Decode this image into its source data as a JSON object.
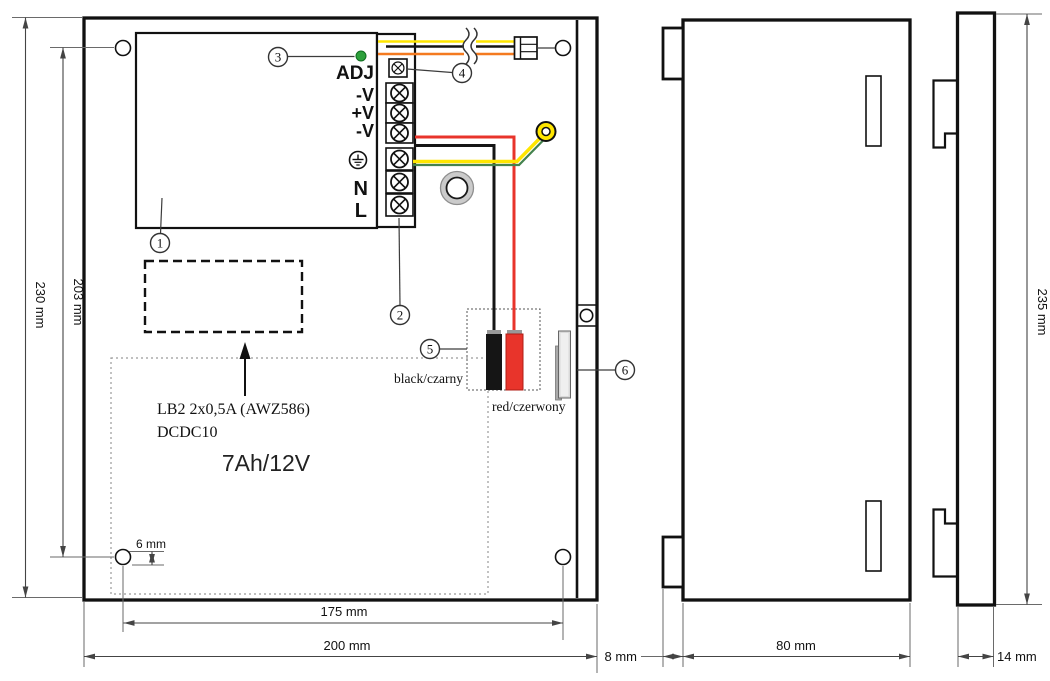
{
  "terminal": {
    "adj": "ADJ",
    "out1": "-V",
    "out2": "+V",
    "out3": "-V",
    "n": "N",
    "l": "L"
  },
  "callouts": [
    "1",
    "2",
    "3",
    "4",
    "5",
    "6"
  ],
  "module": {
    "line1": "LB2 2x0,5A (AWZ586)",
    "line2": "DCDC10"
  },
  "battery_label": "7Ah/12V",
  "wires": {
    "black": "black/czarny",
    "red": "red/czerwony"
  },
  "dims": {
    "front_height": "230 mm",
    "holes_height": "203 mm",
    "hole_diameter": "6 mm",
    "holes_width": "175 mm",
    "front_width": "200 mm",
    "side_height": "235 mm",
    "tab_depth": "8 mm",
    "body_depth": "80 mm",
    "door_depth": "14 mm"
  },
  "colors": {
    "wire_yellow": "#ffe600",
    "wire_orange": "#f47a20",
    "wire_red": "#e8342b",
    "wire_black": "#151515",
    "earth_green": "#44834e",
    "led_green": "#2da03b"
  }
}
